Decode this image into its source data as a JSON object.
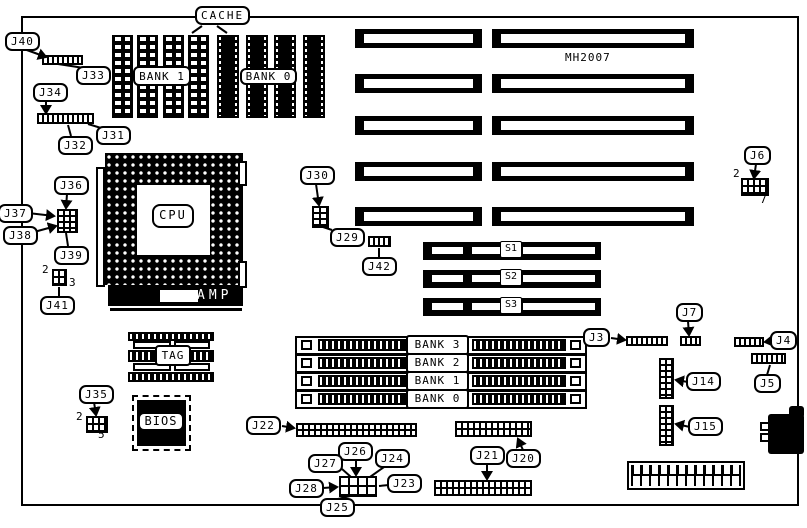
{
  "page": {
    "background": "#ffffff",
    "ink": "#000000"
  },
  "labels": {
    "cache": "CACHE",
    "j40": "J40",
    "j33": "J33",
    "j34": "J34",
    "j32": "J32",
    "j31": "J31",
    "cache_bank1": "BANK 1",
    "cache_bank0": "BANK 0",
    "mh2007": "MH2007",
    "j36": "J36",
    "j37": "J37",
    "j38": "J38",
    "j39": "J39",
    "j41": "J41",
    "cpu": "CPU",
    "amp": "AMP",
    "j30": "J30",
    "j29": "J29",
    "j42": "J42",
    "j6": "J6",
    "j7": "J7",
    "j3": "J3",
    "j4": "J4",
    "j5": "J5",
    "j14": "J14",
    "j15": "J15",
    "s1": "S1",
    "s2": "S2",
    "s3": "S3",
    "tag": "TAG",
    "bios": "BIOS",
    "j35": "J35",
    "simm_bank3": "BANK 3",
    "simm_bank2": "BANK 2",
    "simm_bank1": "BANK 1",
    "simm_bank0": "BANK 0",
    "j22": "J22",
    "j26": "J26",
    "j27": "J27",
    "j24": "J24",
    "j28": "J28",
    "j23": "J23",
    "j25": "J25",
    "j21": "J21",
    "j20": "J20"
  },
  "pins": {
    "j6_pin2": "2",
    "j6_pin7": "7",
    "j41_pin2": "2",
    "j41_pin3": "3",
    "j35_pin2": "2",
    "j35_pin5": "5"
  }
}
